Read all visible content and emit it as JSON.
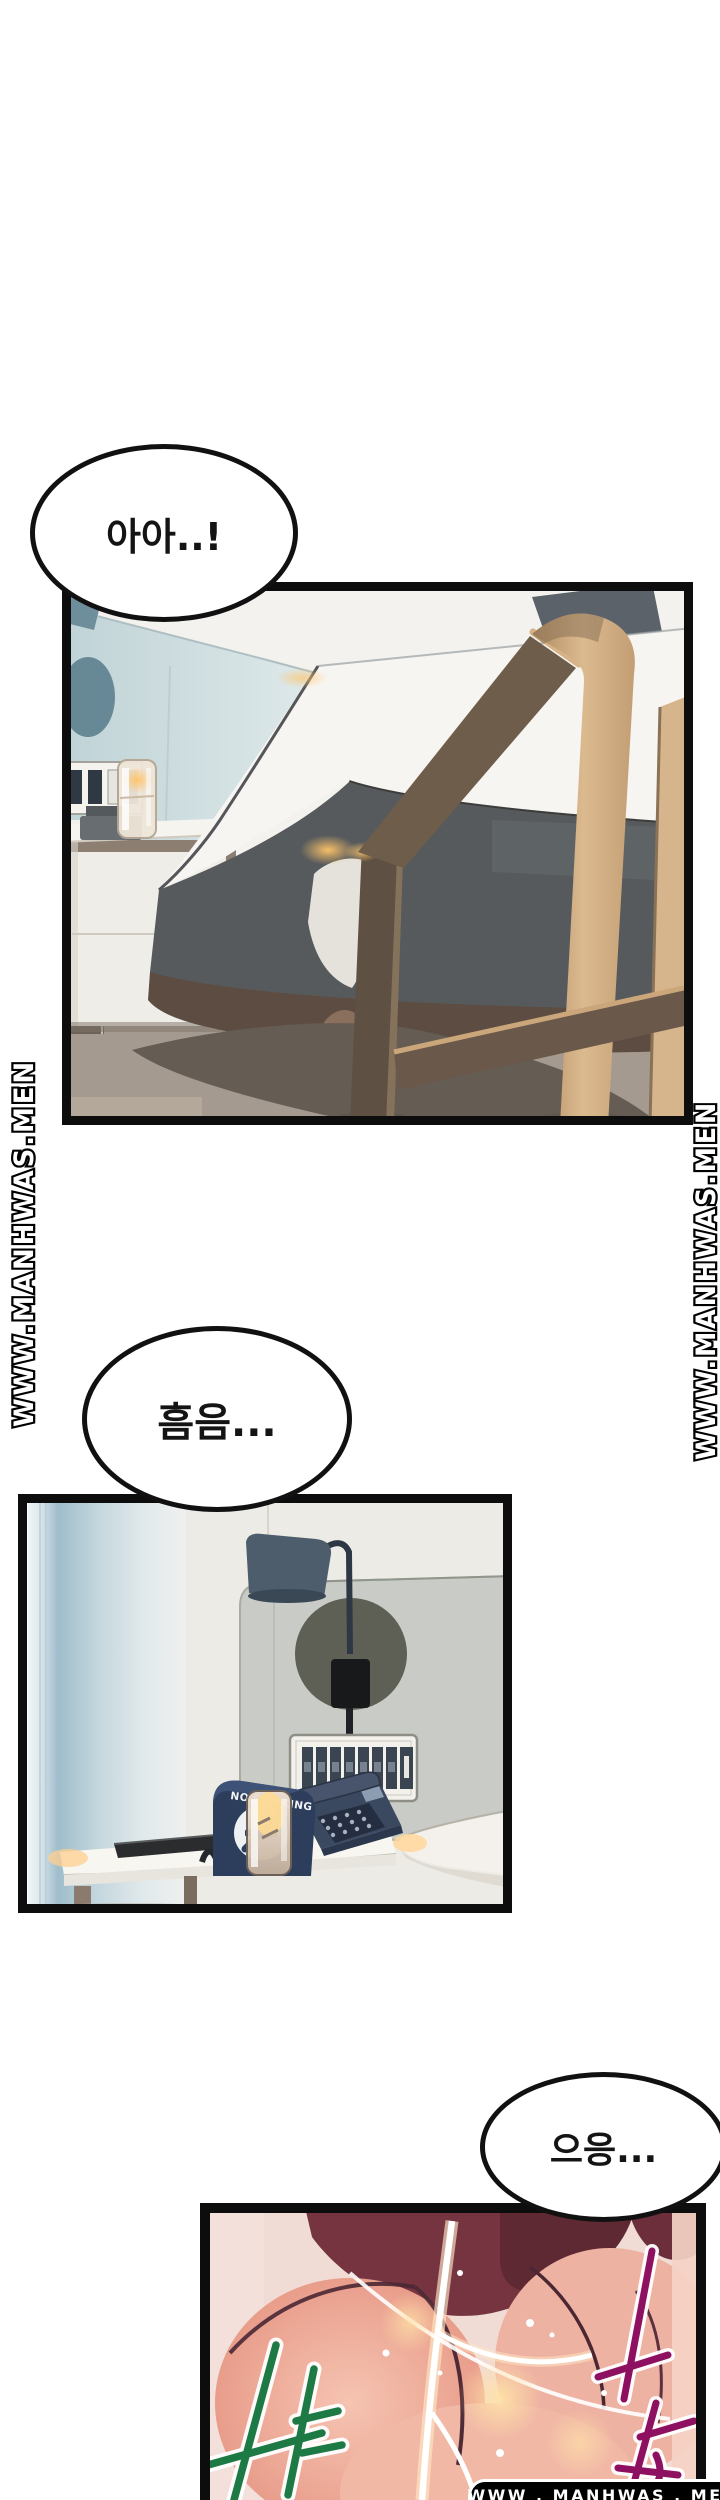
{
  "page": {
    "width": 720,
    "height": 2500,
    "background": "#ffffff"
  },
  "speech_bubbles": [
    {
      "id": "bubble-1",
      "text": "아아..!"
    },
    {
      "id": "bubble-2",
      "text": "흠음..."
    },
    {
      "id": "bubble-3",
      "text": "으응..."
    }
  ],
  "watermarks": {
    "left_vertical": "WWW.MANHWAS.MEN",
    "right_vertical": "WWW.MANHWAS.MEN",
    "bottom_badge": "WWW . MANHWAS . MEN"
  },
  "panels": [
    {
      "id": "panel-1",
      "alt": "hotel room — bed, wooden chair, nightstand, mirror"
    },
    {
      "id": "panel-2",
      "alt": "bedside table — wall lamp, switch panel, telephone, glass",
      "sign_text": "NO SMOKING"
    },
    {
      "id": "panel-3",
      "alt": "stylized close-up",
      "sfx_green_color": "#1d7a44",
      "sfx_magenta_color": "#8e1060"
    }
  ]
}
